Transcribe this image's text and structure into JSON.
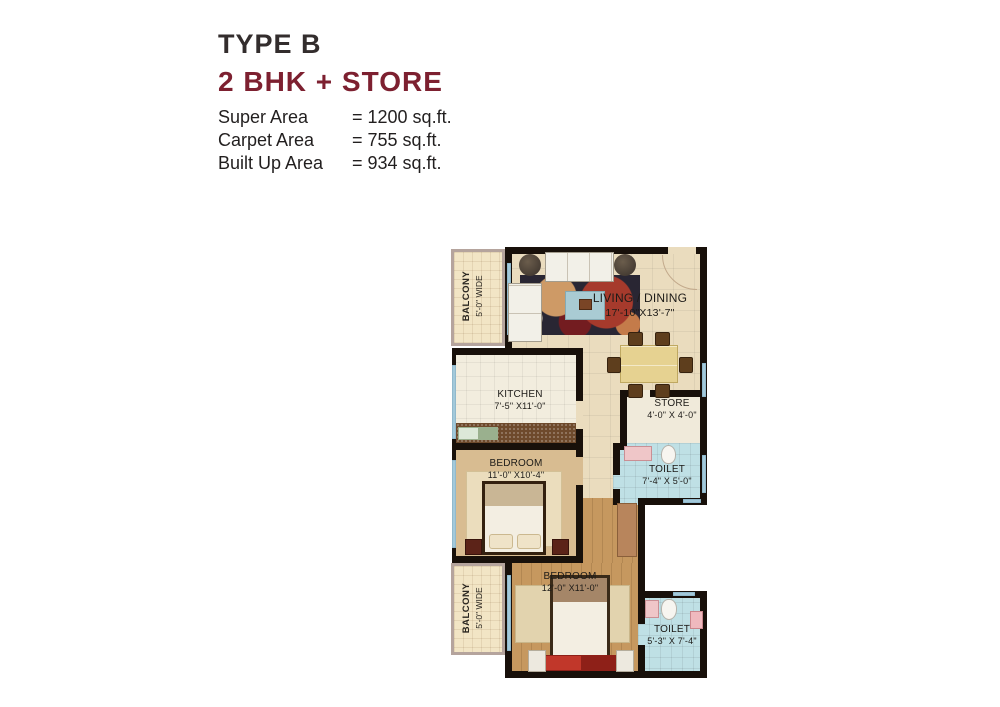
{
  "header": {
    "type_label": "TYPE B",
    "config_label": "2 BHK + STORE",
    "areas": [
      {
        "label": "Super Area",
        "value": "= 1200 sq.ft."
      },
      {
        "label": "Carpet Area",
        "value": "= 755 sq.ft."
      },
      {
        "label": "Built Up Area",
        "value": "= 934 sq.ft."
      }
    ]
  },
  "floorplan": {
    "rooms": [
      {
        "id": "balcony-top",
        "name": "BALCONY",
        "dim": "5'-0\" WIDE"
      },
      {
        "id": "living-dining",
        "name": "LIVING / DINING",
        "dim": "17'-10\"X13'-7\""
      },
      {
        "id": "kitchen",
        "name": "KITCHEN",
        "dim": "7'-5\" X11'-0\""
      },
      {
        "id": "store",
        "name": "STORE",
        "dim": "4'-0\" X 4'-0\""
      },
      {
        "id": "toilet-1",
        "name": "TOILET",
        "dim": "7'-4\" X 5'-0\""
      },
      {
        "id": "bedroom-1",
        "name": "BEDROOM",
        "dim": "11'-0\" X10'-4\""
      },
      {
        "id": "balcony-bottom",
        "name": "BALCONY",
        "dim": "5'-0\" WIDE"
      },
      {
        "id": "bedroom-2",
        "name": "BEDROOM",
        "dim": "12'-0\" X11'-0\""
      },
      {
        "id": "toilet-2",
        "name": "TOILET",
        "dim": "5'-3\" X 7'-4\""
      }
    ],
    "colors": {
      "accent_maroon": "#7d2030",
      "wall_black": "#18100a",
      "window_blue": "#a3c9da",
      "living_floor": "#eadcbe",
      "kitchen_floor": "#f2edde",
      "bedroom1_floor": "#d8bc91",
      "bedroom2_floor": "#c6985f",
      "toilet_floor": "#bfe0e5",
      "balcony_floor": "#f2e5c5"
    }
  }
}
